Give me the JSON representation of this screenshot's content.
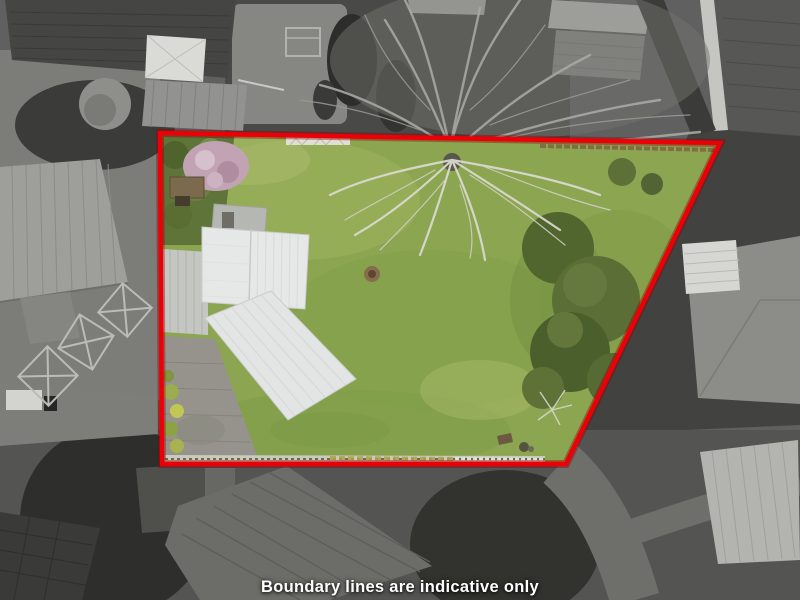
{
  "caption": {
    "text": "Boundary lines are indicative only",
    "color": "#ffffff"
  },
  "boundary": {
    "points": "160,133 720,143 566,464 162,464",
    "stroke_color": "#ec0008",
    "glow_color": "#8f0000"
  },
  "palette": {
    "background_gray": "#5e5e5c",
    "grass": "#8ca550",
    "grass_light": "#a5b968",
    "grass_dark": "#7d9a45",
    "tree_green": "#55693a",
    "blossom_pink": "#c2a3b4",
    "roof_white": "#e6e8e7",
    "driveway_gray": "#95938b",
    "fence_brown": "#7d6847"
  }
}
